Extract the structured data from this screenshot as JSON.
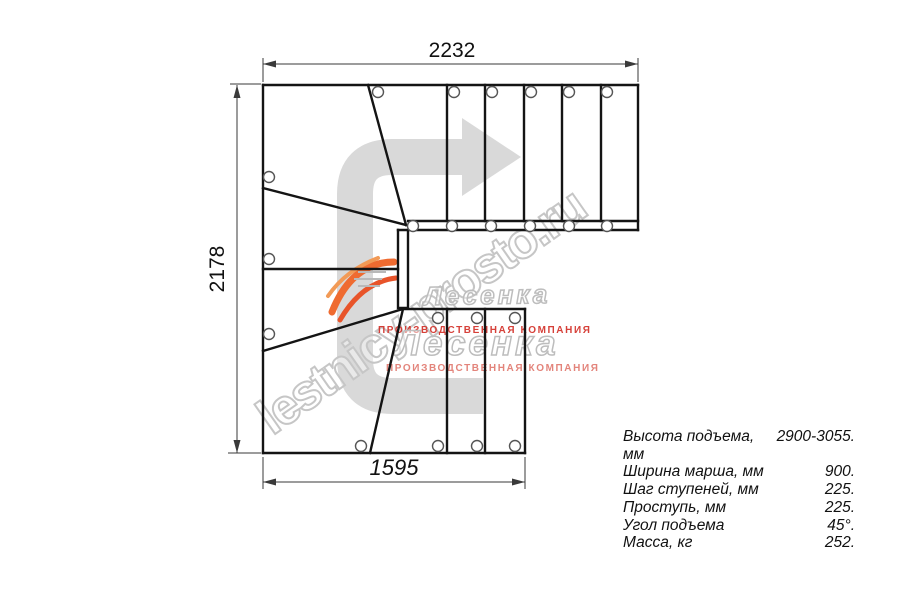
{
  "drawing": {
    "type_note": "staircase plan view, 90-degree turn with winder steps",
    "dimensions": {
      "top_width_mm": "2232",
      "left_height_mm": "2178",
      "bottom_width_mm": "1595"
    }
  },
  "specs": {
    "rows": [
      {
        "label": "Высота подъема, мм",
        "value": "2900-3055."
      },
      {
        "label": "Ширина марша, мм",
        "value": "900."
      },
      {
        "label": "Шаг ступеней, мм",
        "value": "225."
      },
      {
        "label": "Проступь, мм",
        "value": "225."
      },
      {
        "label": "Угол подъема",
        "value": "45°."
      },
      {
        "label": "Масса, кг",
        "value": "252."
      }
    ]
  },
  "watermark": {
    "site": "lestnicy-prosto.ru",
    "brand": "Лесенка",
    "tagline": "ПРОИЗВОДСТВЕННАЯ КОМПАНИЯ"
  },
  "icons": {
    "direction_arrow": "curved-arrow-up-right",
    "hole_marker": "screw-hole-circle"
  },
  "colors": {
    "line": "#141414",
    "dimension": "#3a3a3a",
    "arrow_fill": "#d9d9d9",
    "watermark_stroke": "#c6c6c6",
    "tagline_red": "#d23028",
    "logo_orange": "#ef6b30"
  }
}
